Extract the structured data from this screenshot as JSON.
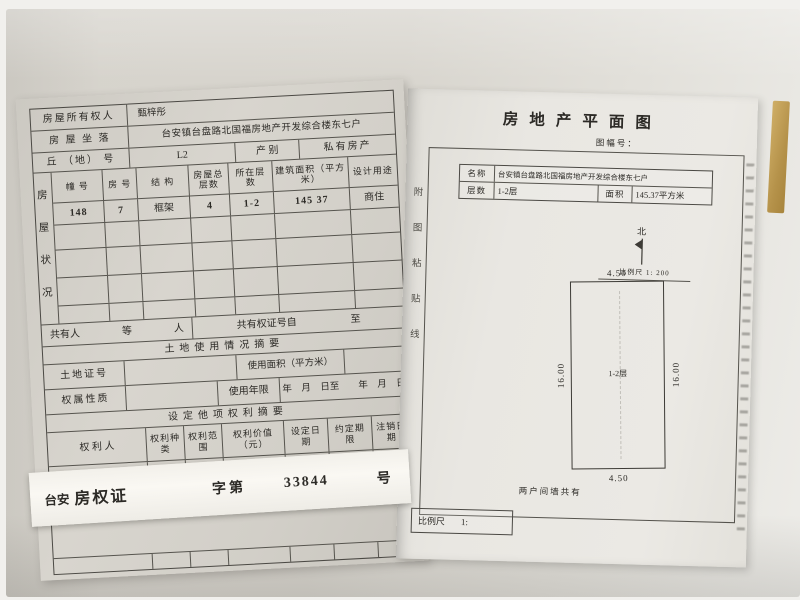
{
  "left_page": {
    "owner_label": "房屋所有权人",
    "owner": "甄梓彤",
    "location_label": "房 屋 坐 落",
    "location": "台安镇台盘路北国福房地产开发综合楼东七户",
    "plot_label": "丘 （地） 号",
    "plot": "L2",
    "category_label": "产 别",
    "category": "私有房产",
    "status_label": "房屋状况",
    "building": {
      "headers": [
        "幢 号",
        "房 号",
        "结 构",
        "房屋总层数",
        "所在层数",
        "建筑面积（平方米）",
        "设计用途"
      ],
      "row": [
        "148",
        "7",
        "框架",
        "4",
        "1-2",
        "145 37",
        "商住"
      ]
    },
    "coowner": {
      "label": "共有人",
      "deng": "等",
      "ren": "人",
      "cert_from": "共有权证号自",
      "to": "至"
    },
    "land": {
      "title": "土地使用情况摘要",
      "cert_label": "土地证号",
      "area_label": "使用面积（平方米）",
      "nature_label": "权属性质",
      "years_label": "使用年限",
      "dates": "年　月　日至　　年　月　日"
    },
    "rights": {
      "title": "设定他项权利摘要",
      "headers": [
        "权  利  人",
        "权利种类",
        "权利范围",
        "权利价值（元）",
        "设定日期",
        "约定期限",
        "注销日期"
      ]
    },
    "strip": {
      "city": "台安",
      "title": "房权证",
      "zi": "字第",
      "number": "33844",
      "hao": "号"
    }
  },
  "right_page": {
    "title": "房地产平面图",
    "sheet_label": "图幅号：",
    "paste_line": "附图粘贴线",
    "info": {
      "name_label": "名称",
      "name": "台安镇台盘路北国福房地产开发综合楼东七户",
      "floors_label": "层数",
      "floors": "1-2层",
      "area_label": "面积",
      "area": "145.37平方米"
    },
    "north": "北",
    "scale_note": "比例尺 1: 200",
    "plan": {
      "width_top": "4.50",
      "width_bottom": "4.50",
      "height_left": "16.00",
      "height_right": "16.00",
      "label": "1-2层"
    },
    "note": "两户间墙共有",
    "scale_box": {
      "label": "比例尺",
      "value": "1:"
    }
  }
}
